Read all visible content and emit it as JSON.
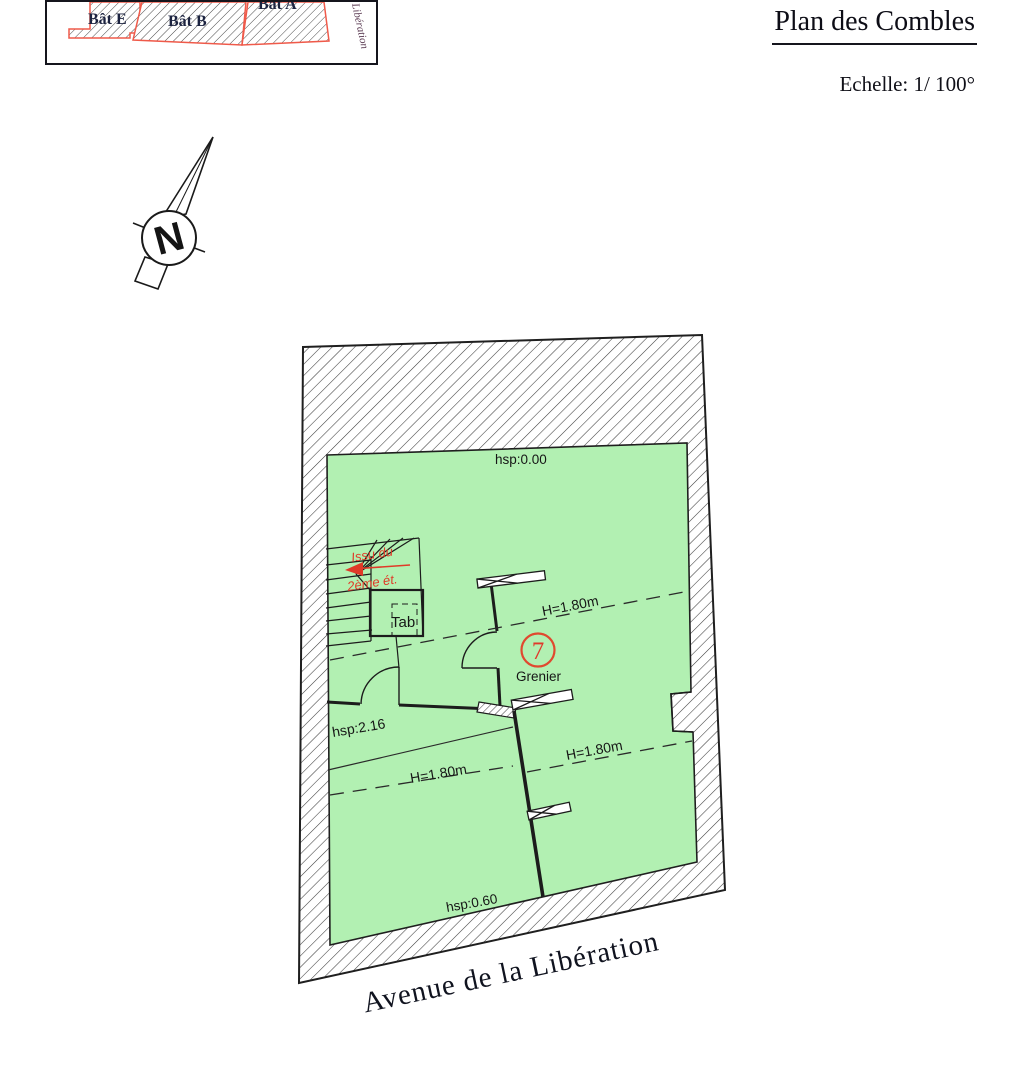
{
  "header": {
    "title": "Plan des Combles",
    "scale": "Echelle: 1/ 100°"
  },
  "inset": {
    "buildings": [
      {
        "label": "Bât E"
      },
      {
        "label": "Bât B"
      },
      {
        "label": "Bât A"
      }
    ],
    "street_label": "Libération"
  },
  "compass": {
    "letter": "N"
  },
  "plan": {
    "room_number": "7",
    "room_name": "Grenier",
    "labels": {
      "hsp_top": "hsp:0.00",
      "hsp_mid": "hsp:2.16",
      "hsp_bottom": "hsp:0.60",
      "h_upper": "H=1.80m",
      "h_lower_left": "H=1.80m",
      "h_lower_right": "H=1.80m",
      "tab": "Tab",
      "stair_note_line1": "Issu du",
      "stair_note_line2": "2ème ét."
    },
    "colors": {
      "room_fill": "#b2f0b2",
      "annotation_red": "#e03a28",
      "outline_red": "#ef5a4a"
    }
  },
  "street": {
    "name": "Avenue de la Libération"
  }
}
